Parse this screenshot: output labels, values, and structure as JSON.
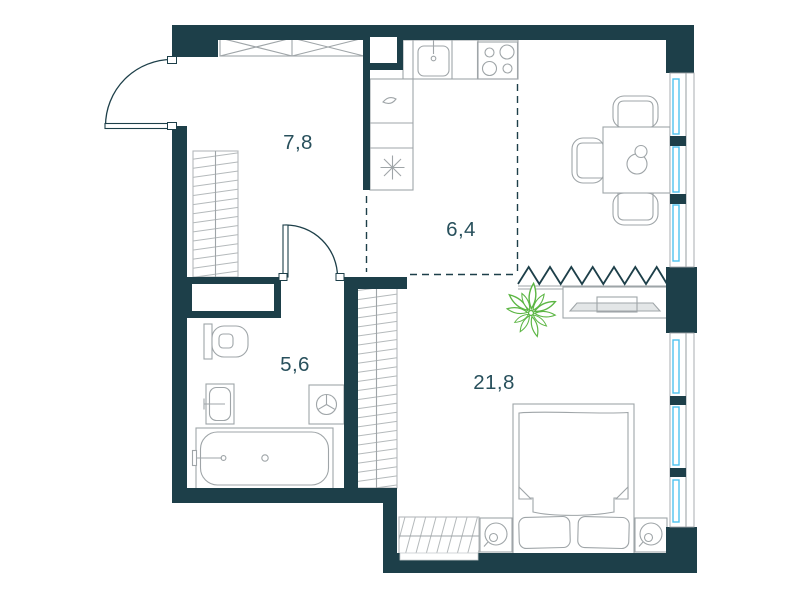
{
  "floor_plan": {
    "type": "apartment-floor-plan",
    "rooms": [
      {
        "name": "hallway",
        "area": "7,8"
      },
      {
        "name": "kitchen",
        "area": "6,4"
      },
      {
        "name": "bathroom",
        "area": "5,6"
      },
      {
        "name": "living_room",
        "area": "21,8"
      }
    ],
    "colors": {
      "wall": "#1d3f49",
      "furniture_stroke": "#9fa5a8",
      "window_glass": "#4fc3ef",
      "plant": "#5cb644",
      "label_text": "#28505c",
      "background": "#ffffff"
    },
    "elements": [
      "entrance-door",
      "hall-closet",
      "hall-wardrobe",
      "ventilation-shaft",
      "kitchen-counter",
      "kitchen-sink",
      "stove",
      "fridge-cabinet",
      "dining-table",
      "dining-chairs",
      "windows",
      "folding-partition",
      "tv-stand",
      "plant",
      "wardrobe",
      "bed",
      "nightstands",
      "table-lamps",
      "radiator-cabinet",
      "toilet",
      "washbasin",
      "washing-machine",
      "bathtub",
      "interior-door"
    ]
  }
}
